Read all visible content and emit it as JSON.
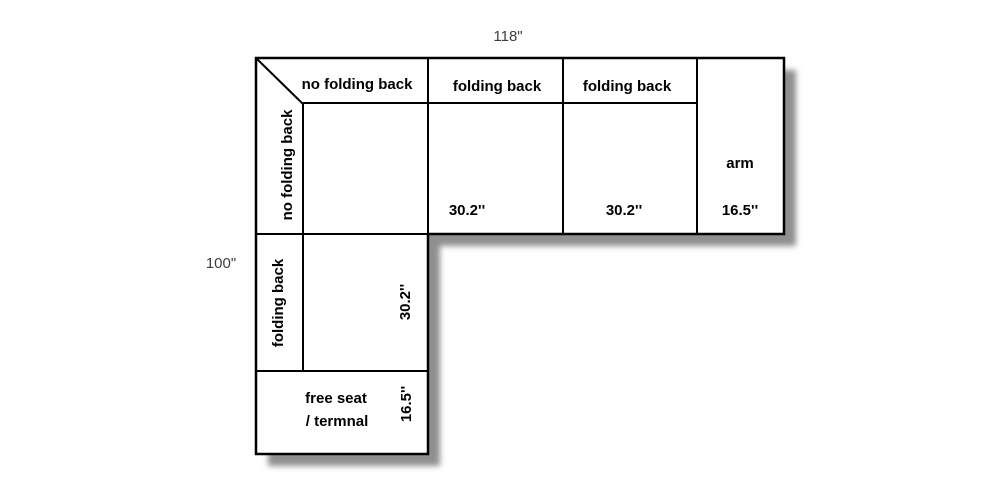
{
  "dimensions": {
    "overall_width": "118\"",
    "overall_height": "100\""
  },
  "top_row": {
    "back_rail_label": "no folding back",
    "headers": [
      "no folding back",
      "folding back",
      "folding back"
    ],
    "seat1_width": "30.2''",
    "seat2_width": "30.2''",
    "arm": {
      "label": "arm",
      "width": "16.5''"
    }
  },
  "left_column": {
    "back_rail_label": "folding back",
    "seat_width": "30.2''",
    "end_seat": {
      "label_line1": "free seat",
      "label_line2": "/ termnal",
      "width": "16.5''"
    }
  },
  "colors": {
    "outline": "#000000",
    "fill": "#ffffff",
    "shadow": "#8f8f8f",
    "dimension_text": "#3d3d3d",
    "background": "#ffffff"
  }
}
